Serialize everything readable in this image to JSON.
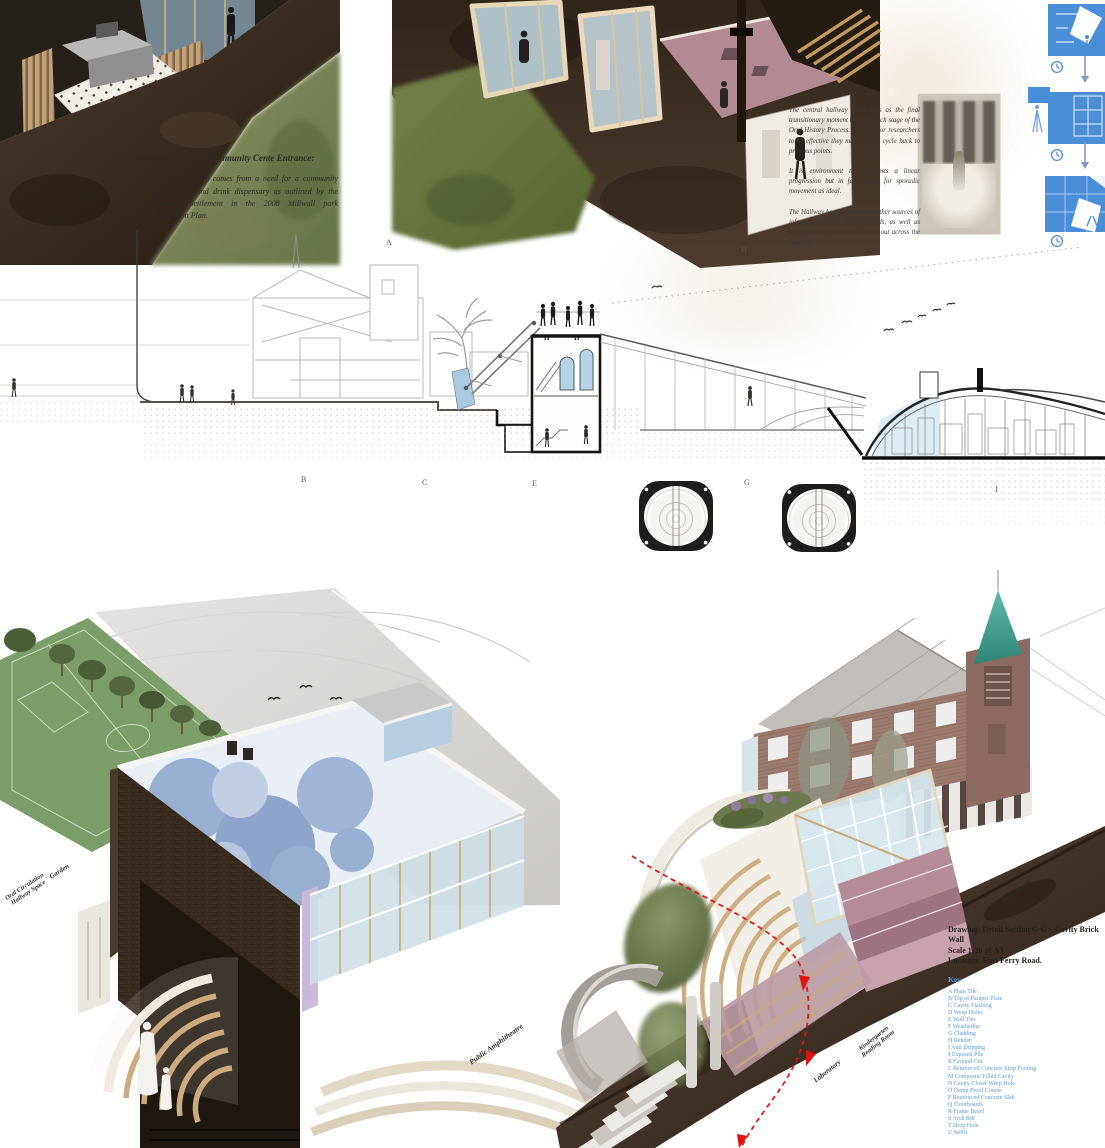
{
  "notes": {
    "cafe": {
      "title": "Bowsprit Cafe and Community Cente Entrance:",
      "body": "The Bowsprit cafe comes from a need for a community targeted food and drink dispensary as outlined by the Docklands Settlement in the 2008 Millwall park Management Plan."
    },
    "hallway": {
      "p1": "The central hallway space acts as the final transitionary moment between each stage of the Oral History Process. In order for researchers to be effective they may have to cycle back to previous points.",
      "p2": "It is environment that suggests a linear progression but in fact allows for sporadic movement as ideal.",
      "p3": "The Hallway houses books and other sources of information about the Docklands, as well as navigable entrances and a view out across the Garden."
    }
  },
  "section": {
    "letters": [
      "A",
      "H",
      "B",
      "C",
      "E",
      "G",
      "I"
    ],
    "tower_label_left": "H",
    "tower_label_right": "H"
  },
  "labels": {
    "garden": "Garden",
    "hallway_line1": "Oral Circulation",
    "hallway_line2": "Hallway Space",
    "amphitheatre": "Public Amphitheatre",
    "laboratory": "Laboratory",
    "kindergarten_line1": "Kindergarten",
    "kindergarten_line2": "Reading Room",
    "playground": "Playground"
  },
  "detail_note": {
    "drawing_line": "Drawing:  Detail Section G-G – Cavity Brick Wall",
    "scale_line": "Scale 1:20 @ A3",
    "location_line": "Location:  East Ferry Road.",
    "key_title": "Key",
    "key_items": [
      "A   Plain Tile",
      "B   Top of Parapet Plate",
      "C   Cavity Flashing",
      "D   Weep Holes",
      "E   Wall Ties",
      "F   Weatherbar",
      "G   Cladding",
      "H   Render",
      "I   Anti Dripping",
      "J   Exposed Pile",
      "K   Ground Cut",
      "L   Reinforced Concrete Strip Footing",
      "M   Composite Filled Cavity",
      "N   Cavity Closer Weep Hole",
      "O   Damp Proof Course",
      "P   Reinforced Concrete Slab",
      "Q   Floorboards",
      "R   Frame Bevel",
      "S   Arch Rib",
      "T   Drop Hole",
      "U   Soffit"
    ]
  },
  "colors": {
    "diagram_blue": "#4a8ed8",
    "key_text_blue": "#5a9bd0",
    "arrow_red": "#e01212",
    "spire_teal": "#4aa391"
  }
}
